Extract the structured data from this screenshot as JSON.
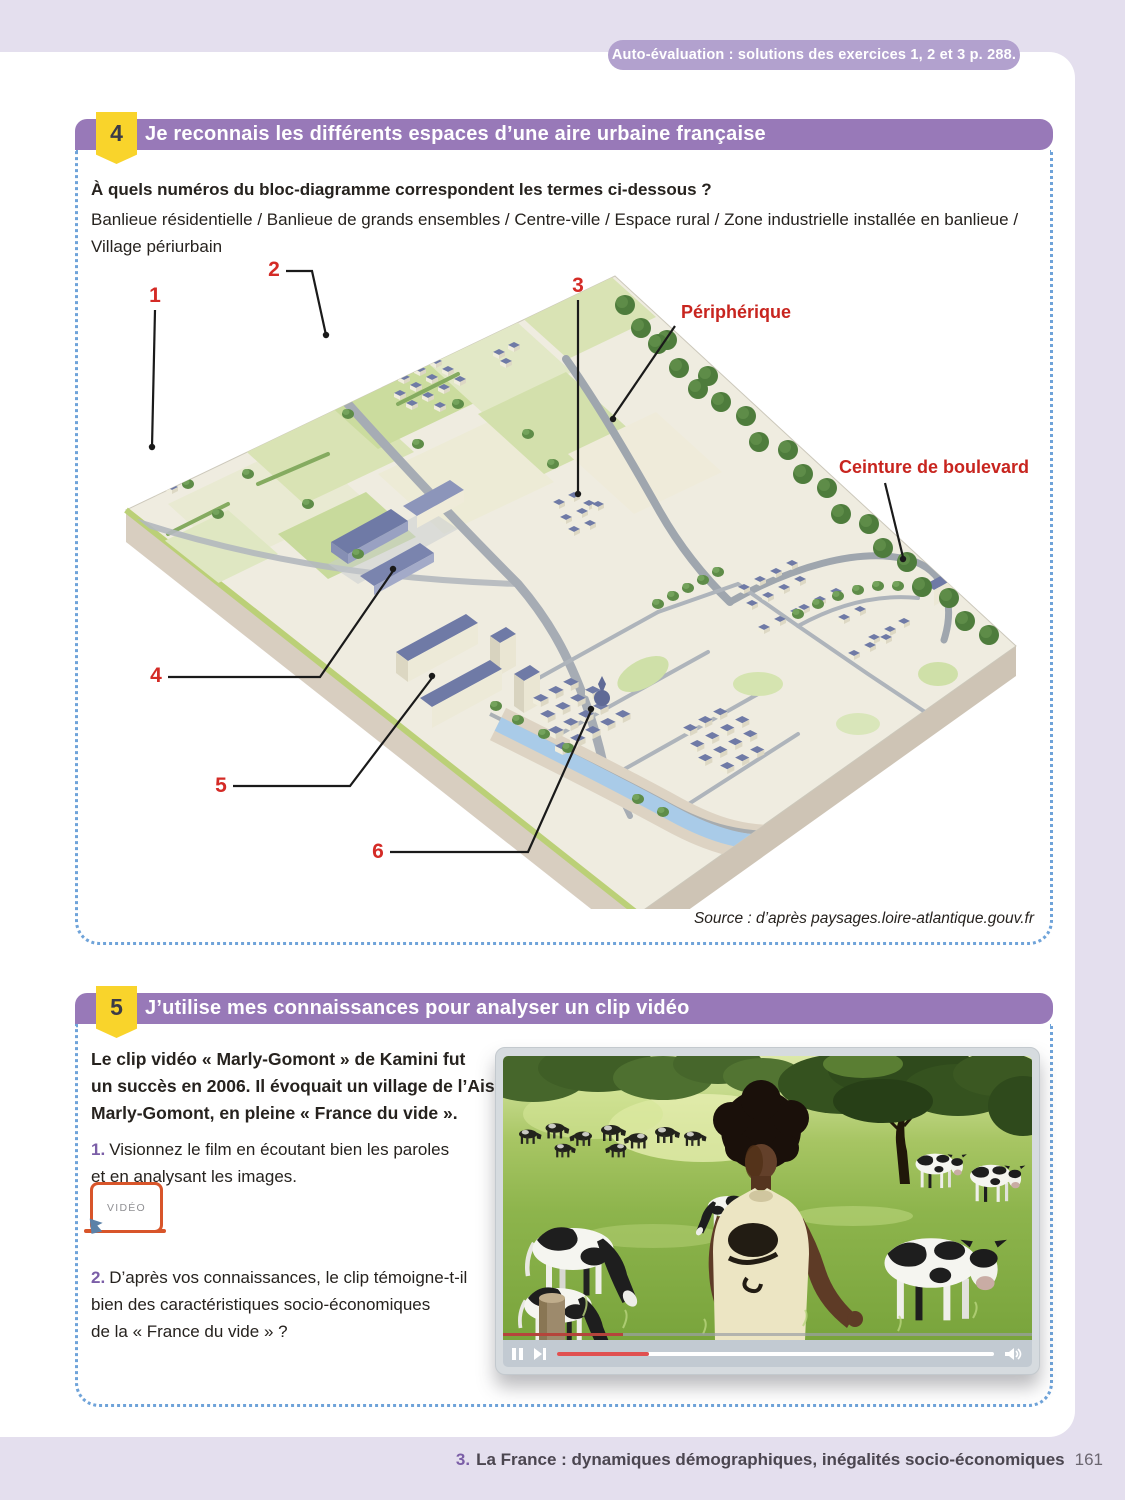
{
  "page": {
    "banner": "Auto-évaluation : solutions des exercices 1, 2 et 3 p. 288.",
    "footer": {
      "chapter_num": "3.",
      "chapter_title": "La France : dynamiques démographiques, inégalités socio-économiques",
      "page_number": "161"
    }
  },
  "colors": {
    "lavender_bg": "#E4DFEE",
    "purple_bar": "#9879B8",
    "badge_yellow": "#F9D42B",
    "dotted_blue": "#6FA3D9",
    "label_red": "#D42B26",
    "question_purple": "#7B5EA7",
    "link_orange": "#D8552A",
    "progress_red": "#E05050"
  },
  "exercise4": {
    "number": "4",
    "title": "Je reconnais les différents espaces d’une aire urbaine française",
    "question": "À quels numéros du bloc-diagramme correspondent les termes ci-dessous ?",
    "terms": "Banlieue résidentielle / Banlieue de grands ensembles / Centre-ville / Espace rural / Zone industrielle installée en banlieue / Village périurbain",
    "diagram": {
      "labels": {
        "n1": "1",
        "n2": "2",
        "n3": "3",
        "n4": "4",
        "n5": "5",
        "n6": "6",
        "peripherique": "Périphérique",
        "ceinture": "Ceinture de boulevards"
      },
      "source": "Source : d’après paysages.loire-atlantique.gouv.fr"
    }
  },
  "exercise5": {
    "number": "5",
    "title": "J’utilise mes connaissances pour analyser un clip vidéo",
    "intro_lines": [
      "Le clip vidéo « Marly-Gomont » de Kamini fut",
      "un succès en 2006. Il évoquait un village de l’Aisne,",
      "Marly-Gomont, en pleine « France du vide »."
    ],
    "q1": {
      "num": "1.",
      "lines": [
        "Visionnez le film en écoutant bien les paroles",
        "et en analysant les images."
      ]
    },
    "q2": {
      "num": "2.",
      "lines": [
        "D’après vos connaissances, le clip témoigne-t-il",
        "bien des caractéristiques socio-économiques",
        "de la « France du vide » ?"
      ]
    },
    "video_button_label": "VIDÉO"
  }
}
